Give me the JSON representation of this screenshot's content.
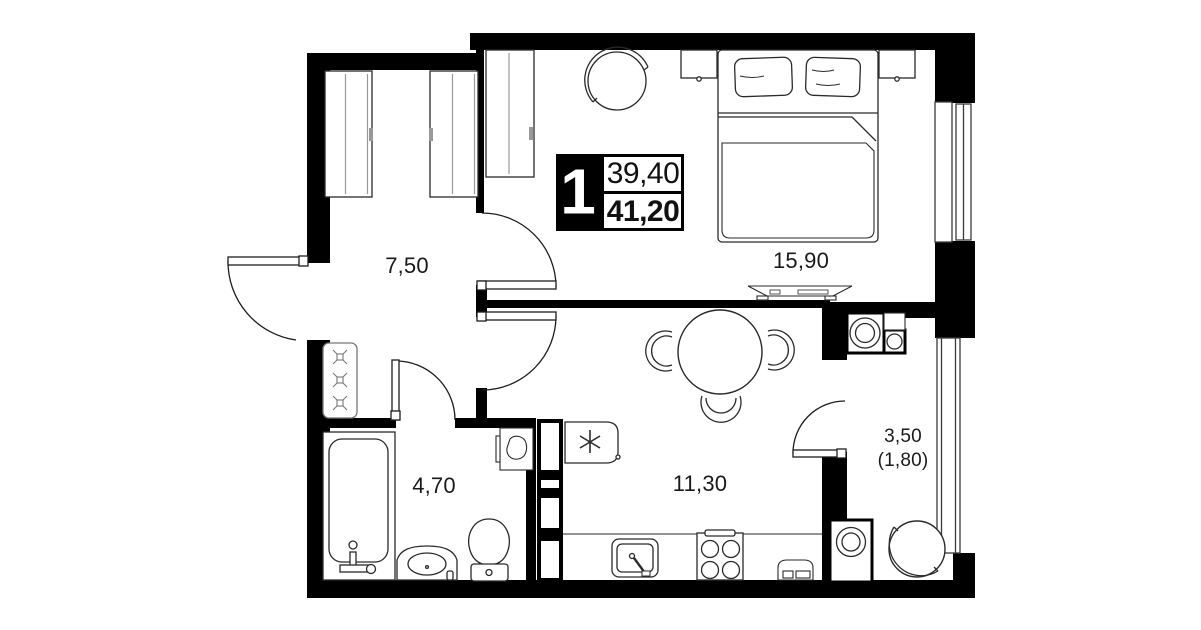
{
  "floor_plan": {
    "unit_badge": {
      "rooms_count": "1",
      "living_area": "39,40",
      "total_area": "41,20"
    },
    "rooms": [
      {
        "name": "hallway",
        "area": "7,50"
      },
      {
        "name": "bedroom",
        "area": "15,90"
      },
      {
        "name": "bathroom",
        "area": "4,70"
      },
      {
        "name": "kitchen-living-room",
        "area": "11,30"
      },
      {
        "name": "balcony",
        "area": "3,50",
        "area_reduced": "(1,80)"
      }
    ],
    "icons": [
      "double-bed-icon",
      "pillow-icon",
      "nightstand-icon",
      "tv-stand-icon",
      "round-armchair-icon",
      "wardrobe-icon",
      "dining-table-icon",
      "chair-icon",
      "fridge-snowflake-icon",
      "sink-icon",
      "stove-icon",
      "radiator-icon",
      "bathtub-icon",
      "vanity-sink-icon",
      "toilet-icon",
      "washing-machine-icon",
      "round-chair-icon",
      "door-swing-icon",
      "window-icon",
      "duct-shaft-icon"
    ],
    "colors": {
      "walls": "#000000",
      "background": "#ffffff",
      "furniture_line": "#1d1d1d",
      "detail_line": "#999999"
    }
  }
}
